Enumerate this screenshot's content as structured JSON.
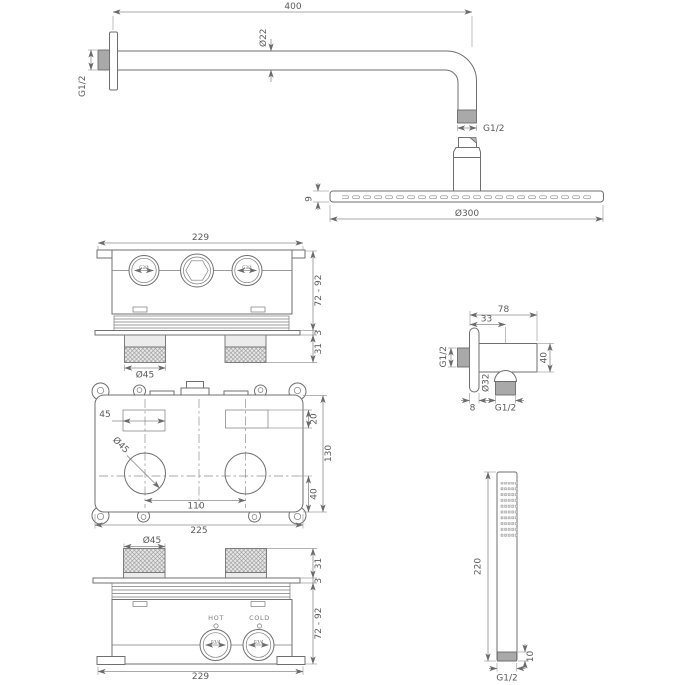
{
  "drawing": {
    "type": "technical-dimension-drawing",
    "subject": "concealed thermostatic shower set",
    "colors": {
      "line": "#6f6f6f",
      "dim_line": "#8c8c8c",
      "text": "#5a5a5a",
      "metal_fill": "#a9a9a9",
      "light_fill": "#ececec",
      "background": "#ffffff"
    }
  },
  "labels": {
    "top": {
      "arm_length": "400",
      "arm_diameter": "Ø22",
      "wall_thread": "G1/2",
      "end_thread": "G1/2",
      "head_thickness": "9",
      "head_diameter": "Ø300"
    },
    "valve_top": {
      "width": "229",
      "depth_range": "72 - 92",
      "plate_thickness": "3",
      "knob_height": "31",
      "knob_diameter": "Ø45",
      "port_left": "G3/4",
      "port_right": "G3/4"
    },
    "valve_front": {
      "slot_width": "45",
      "slot_height": "20",
      "body_height": "130",
      "hole_diameter": "Ø45",
      "hole_spacing": "110",
      "hole_center_height": "40",
      "body_width": "225"
    },
    "outlet": {
      "width": "78",
      "center_offset": "33",
      "inlet_thread": "G1/2",
      "outlet_diameter": "Ø32",
      "height": "40",
      "plate_thickness": "8",
      "outlet_thread": "G1/2"
    },
    "valve_bottom": {
      "knob_diameter": "Ø45",
      "knob_height": "31",
      "plate_thickness": "3",
      "depth_range": "72 - 92",
      "width": "229",
      "hot": "HOT",
      "cold": "COLD",
      "port_left": "G3/4",
      "port_right": "G3/4"
    },
    "hand_shower": {
      "length": "220",
      "connector_height": "10",
      "thread": "G1/2"
    }
  }
}
